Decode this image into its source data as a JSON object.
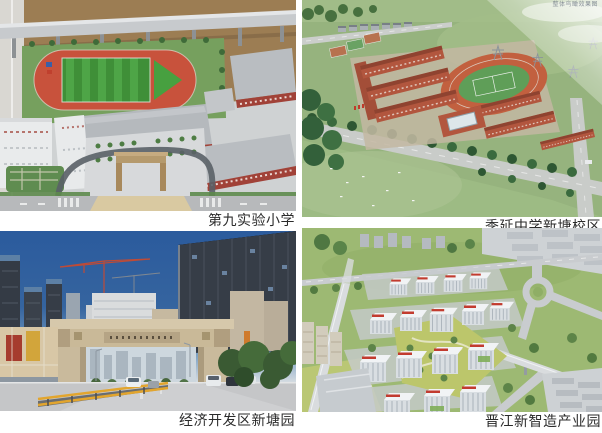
{
  "page": {
    "background_color": "#ffffff",
    "language": "zh-CN"
  },
  "gallery": {
    "caption_color": "#2b2b2b",
    "items": [
      {
        "caption": "第九实验小学"
      },
      {
        "caption": "季延中学新塘校区",
        "watermark": "整体鸟瞰效果图"
      },
      {
        "caption": "经济开发区新塘园"
      },
      {
        "caption": "晋江新智造产业园"
      }
    ]
  },
  "colors": {
    "sky_blue": "#2d5d9d",
    "track_red": "#c8523c",
    "terracotta_building": "#b2563e",
    "grass_green": "#9cb873",
    "gate_stone_beige": "#c9ba9c",
    "guardrail_yellow": "#e2a52e"
  }
}
